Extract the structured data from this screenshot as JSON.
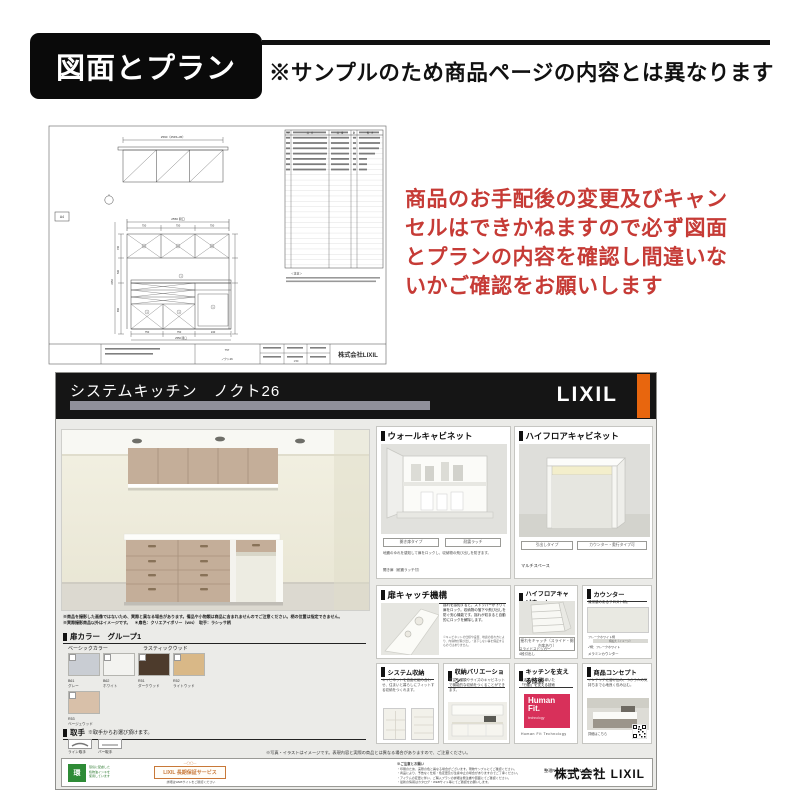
{
  "header": {
    "badge": "図面とプラン",
    "note": "※サンプルのため商品ページの内容とは異なります"
  },
  "warning": {
    "line1": "商品のお手配後の変更及びキャン",
    "line2": "セルはできかねますので必ず図面",
    "line3": "とプランの内容を確認し間違いな",
    "line4": "いかご確認をお願いします"
  },
  "drawing": {
    "company": "株式会社LIXIL",
    "page_label": "A4",
    "plan_dim": "2590（2545+45）",
    "elev_dim_total": "2550 間口",
    "seg1": "750",
    "seg2": "750",
    "seg3": "750",
    "base1": "750",
    "base2": "750",
    "base3": "240",
    "h_total": "2350",
    "h1": "700",
    "h2": "500",
    "h3": "850",
    "table": {
      "c1": "№",
      "c2": "品　名",
      "c3": "品　番",
      "c4": "数",
      "c5": "備　考"
    },
    "note_head": "＜注意＞",
    "block_plan": "757",
    "block_name": "ノクト26",
    "scale": "1:50"
  },
  "sheet": {
    "title": "システムキッチン　ノクト26",
    "brand": "LIXIL",
    "disclaimer1": "※商品を撮影した画像ではないため、実際と異なる場合があります。備品や小物類は商品に含まれませんのでご注意ください。柄の位置は指定できません。",
    "disclaimer2": "※実際撮影商品以外はイメージです。　＊扉色：クリエアイボリー（WN）　取手：ラシッサ柄",
    "door_color": {
      "title": "扉カラー　グループ1",
      "group1": "ベーシックカラー",
      "group2": "ラスティックウッド",
      "swatches": [
        {
          "code": "B61",
          "name": "グレー",
          "color": "#c9cdd3"
        },
        {
          "code": "B62",
          "name": "ホワイト",
          "color": "#f3f3f0"
        },
        {
          "code": "R51",
          "name": "ダークウッド",
          "color": "#4d3b2c"
        },
        {
          "code": "R52",
          "name": "ライトウッド",
          "color": "#d9b887"
        },
        {
          "code": "R53",
          "name": "ベージュウッド",
          "color": "#d8c0a9"
        }
      ]
    },
    "handle": {
      "title": "取手",
      "note": "※取手からお選び頂けます。",
      "item1": "ライン取手",
      "item2": "バー取手"
    },
    "worktop": {
      "title": "ワークトップ",
      "button": "選択"
    },
    "sink": {
      "title": "シンク",
      "button": "選択"
    },
    "panels": {
      "wall": {
        "title": "ウォールキャビネット",
        "btn1": "開き扉タイプ",
        "btn2": "耐震ラッチ",
        "note": "地震のゆれを感知して扉をロックし、収納物の飛び出しを防ぎます。",
        "caption": "開き扉（耐震ラッチ付）"
      },
      "hifloor": {
        "title": "ハイフロアキャビネット",
        "btn1": "引出しタイプ",
        "btn2": "カウンター・奥行タイプ可",
        "caption": "マルチスペース"
      },
      "catch": {
        "title": "扉キャッチ機構",
        "body": "揺れを感知すると、ストッパーが下りて扉をロック。収納物の落下や飛び出しを防ぐ安心機能です。揺れが収まると自動的にロックを解除します。",
        "note": "※キャビネットの仕様や設置、地震の揺れ方により、内容物が飛び出し・落下しない事を保証するものではありません。"
      },
      "hifloor2": {
        "title": "ハイフロアキャビネット",
        "caption1": "揺れをキャッチ（スライド・開き扉あり）",
        "caption2": "スライドストッカー",
        "caption3": "4段引出し"
      },
      "counter": {
        "title": "カウンター",
        "body": "清潔感のあるフロスト柄。",
        "label1": "フレークホワイト柄",
        "label2": "柄拡大（イメージ）",
        "swatch_note": "✓柄：フレークホワイト",
        "caption": "メラミンカウンター",
        "color": "#e9e9e2"
      },
      "sys": {
        "title": "システム収納",
        "body": "キャビネットを自由に組み合わせ、住まいと暮らしにフィットする収納をつくれます。"
      },
      "vari": {
        "title": "収納バリエーション",
        "body": "豊富な種類やサイズのキャビネットで機能的な収納をつくることができます。"
      },
      "tech": {
        "title": "キッチンを支える技術",
        "body1": "生活者研究から導いた",
        "body2": "「行動」を支える技術",
        "logo1": "Human",
        "logo2": "Fit.",
        "logo3": "technology",
        "logo_color": "#d8305a",
        "caption": "Human Fit Technology"
      },
      "concept": {
        "title": "商品コンセプト",
        "body": "インテリアに溶け込み、つかう人の気持ちまで心地良く包み込む。",
        "caption": "詳細はこちら"
      }
    },
    "footnote": "※写真・イラストはイメージです。表現内容と実際の商品とは異なる場合がありますので、ご注意ください。",
    "footer": {
      "green_mark": "環",
      "green_text1": "環境に配慮した",
      "green_text2": "植物油インキを",
      "green_text3": "使用しています",
      "warranty_deco": "—◯◯—",
      "warranty": "LIXIL 長期保証サービス",
      "warranty_sub": "詳細はWEBサイトをご確認ください",
      "notes_head": "※ご注意とお願い",
      "note1": "・印刷のため、実際の色と異なる場合がございます。現物サンプルにてご確認ください。",
      "note2": "・商品により、予告なく仕様・色変更及び生産中止の場合がありますのでご了承ください。",
      "note3": "・アイテムの変更に伴い、ご購入プランの詳細は発注書や図面にてご確認ください。",
      "note4": "・最新の情報はカタログ・WEBサイト等にてご確認をお願いします。",
      "id1": "整理No：NR2021016-AD-001-1",
      "id2": "（123456）",
      "company": "株式会社 LIXIL"
    }
  }
}
